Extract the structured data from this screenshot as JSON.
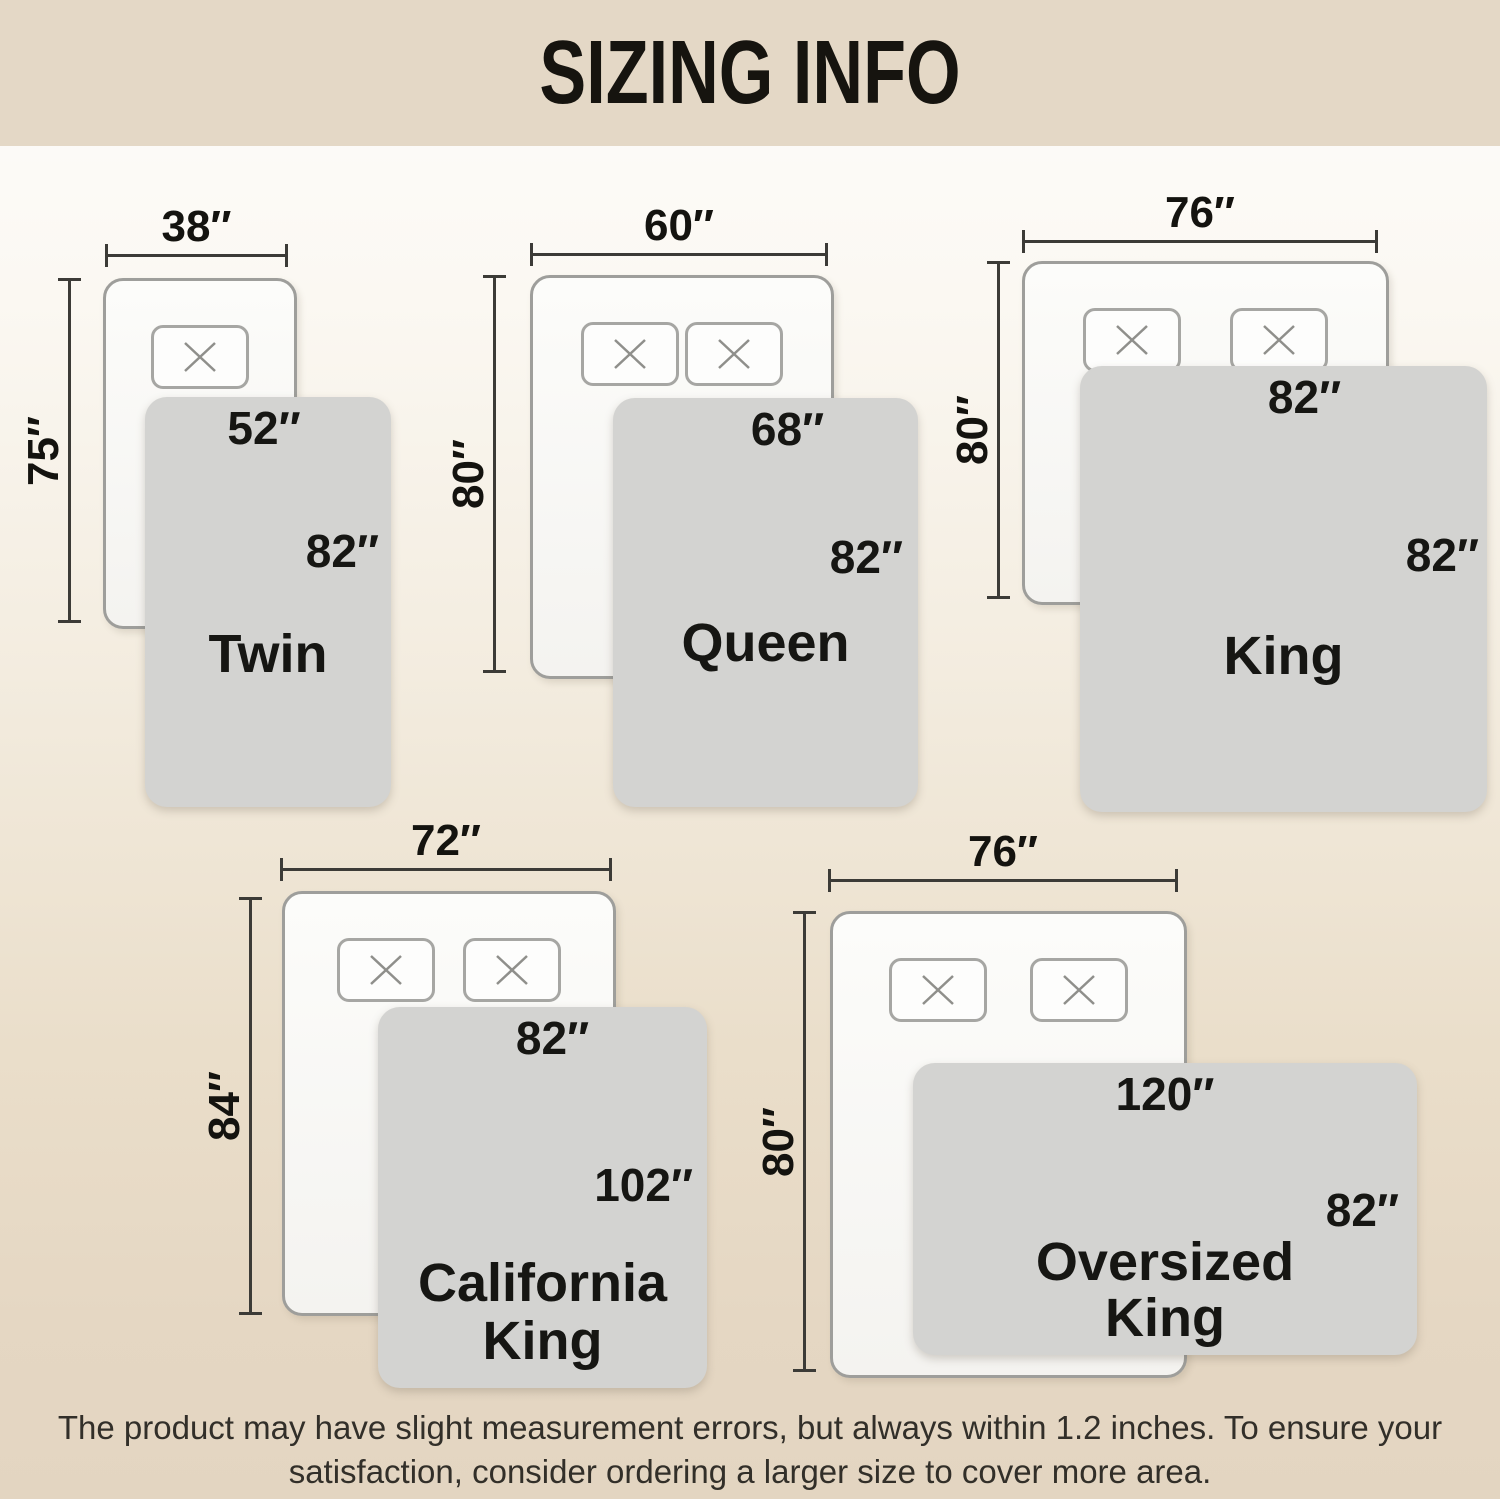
{
  "header": {
    "title": "SIZING INFO"
  },
  "colors": {
    "header_bg": "#e4d8c6",
    "footer_bg": "#e3d5c1",
    "blanket_gray": "#d3d3d1",
    "bed_border": "#9e9e9b",
    "dimension_line": "#3c3b37",
    "text": "#161613"
  },
  "diagrams": [
    {
      "id": "twin",
      "name": "Twin",
      "bed_width": "38″",
      "bed_height": "75″",
      "blanket_width": "52″",
      "blanket_length": "82″",
      "pillow_count": 1
    },
    {
      "id": "queen",
      "name": "Queen",
      "bed_width": "60″",
      "bed_height": "80″",
      "blanket_width": "68″",
      "blanket_length": "82″",
      "pillow_count": 2
    },
    {
      "id": "king",
      "name": "King",
      "bed_width": "76″",
      "bed_height": "80″",
      "blanket_width": "82″",
      "blanket_length": "82″",
      "pillow_count": 2
    },
    {
      "id": "california-king",
      "name_line1": "California",
      "name_line2": "King",
      "bed_width": "72″",
      "bed_height": "84″",
      "blanket_width": "82″",
      "blanket_length": "102″",
      "pillow_count": 2
    },
    {
      "id": "oversized-king",
      "name_line1": "Oversized",
      "name_line2": "King",
      "bed_width": "76″",
      "bed_height": "80″",
      "blanket_width": "120″",
      "blanket_length": "82″",
      "pillow_count": 2
    }
  ],
  "footer": {
    "line1": "The product may have slight measurement errors, but always within 1.2 inches. To ensure your",
    "line2": "satisfaction, consider ordering a larger size to cover more area."
  }
}
